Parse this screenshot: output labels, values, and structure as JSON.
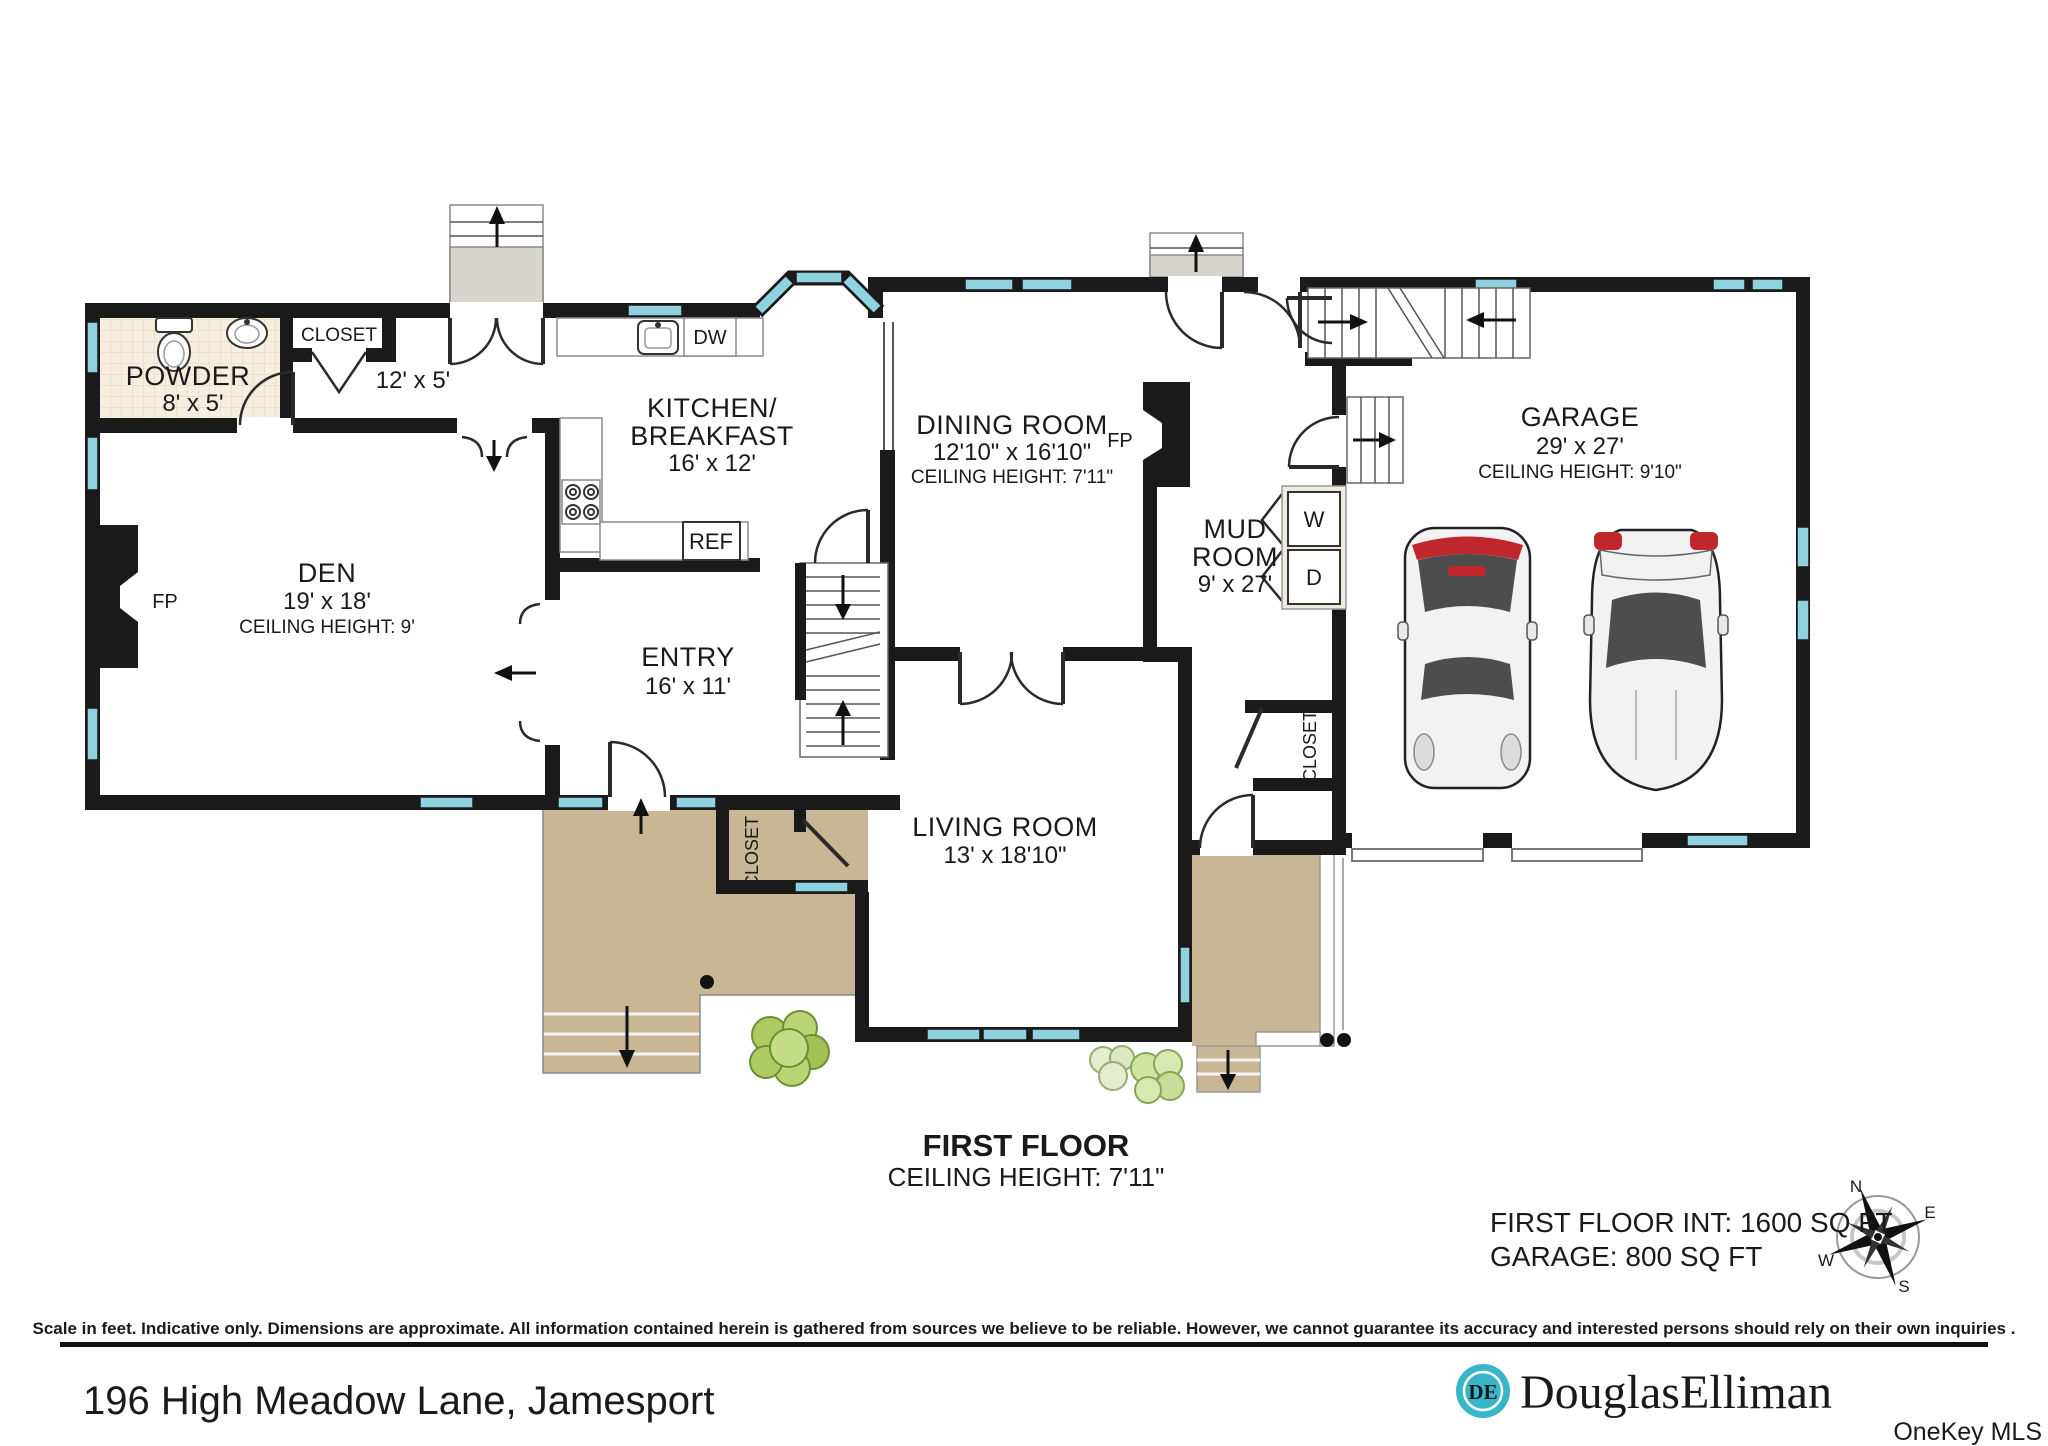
{
  "plan": {
    "rooms": {
      "powder": {
        "name": "POWDER",
        "dims": "8' x 5'"
      },
      "hall_closet": {
        "name": "CLOSET"
      },
      "hall": {
        "dims": "12' x 5'"
      },
      "kitchen": {
        "line1": "KITCHEN/",
        "line2": "BREAKFAST",
        "dims": "16' x 12'"
      },
      "dining": {
        "name": "DINING ROOM",
        "dims": "12'10\" x 16'10\"",
        "ceiling": "CEILING HEIGHT: 7'11\""
      },
      "den": {
        "name": "DEN",
        "dims": "19' x 18'",
        "ceiling": "CEILING HEIGHT: 9'"
      },
      "entry": {
        "name": "ENTRY",
        "dims": "16' x 11'"
      },
      "living": {
        "name": "LIVING ROOM",
        "dims": "13' x 18'10\""
      },
      "mud": {
        "line1": "MUD",
        "line2": "ROOM",
        "dims": "9' x 27'"
      },
      "garage": {
        "name": "GARAGE",
        "dims": "29' x 27'",
        "ceiling": "CEILING HEIGHT: 9'10\""
      },
      "entry_closet": {
        "name": "CLOSET"
      },
      "mud_closet": {
        "name": "CLOSET"
      }
    },
    "fixtures": {
      "fireplace": "FP",
      "dishwasher": "DW",
      "refrigerator": "REF",
      "washer": "W",
      "dryer": "D"
    },
    "title": {
      "line1": "FIRST FLOOR",
      "line2": "CEILING HEIGHT: 7'11\""
    },
    "areas": {
      "line1": "FIRST FLOOR INT: 1600 SQ FT",
      "line2": "GARAGE: 800 SQ FT"
    },
    "compass": {
      "north": "N",
      "east": "E",
      "south": "S",
      "west": "W"
    }
  },
  "footer": {
    "disclaimer": "Scale in feet. Indicative only. Dimensions are approximate. All information contained herein is gathered from sources we believe to be reliable. However, we cannot guarantee its accuracy and interested persons should rely on their own inquiries .",
    "address": "196 High Meadow Lane, Jamesport",
    "brand": "DouglasElliman",
    "brand_monogram": "DE",
    "mls": "OneKey MLS"
  },
  "colors": {
    "wall": "#1a1a1a",
    "window": "#8ed2e0",
    "porch": "#c9b694",
    "stair_fill": "#d8d4ce",
    "brand_teal": "#38b6c9",
    "brand_navy": "#1d2b47",
    "bush": "#b5d36f"
  }
}
